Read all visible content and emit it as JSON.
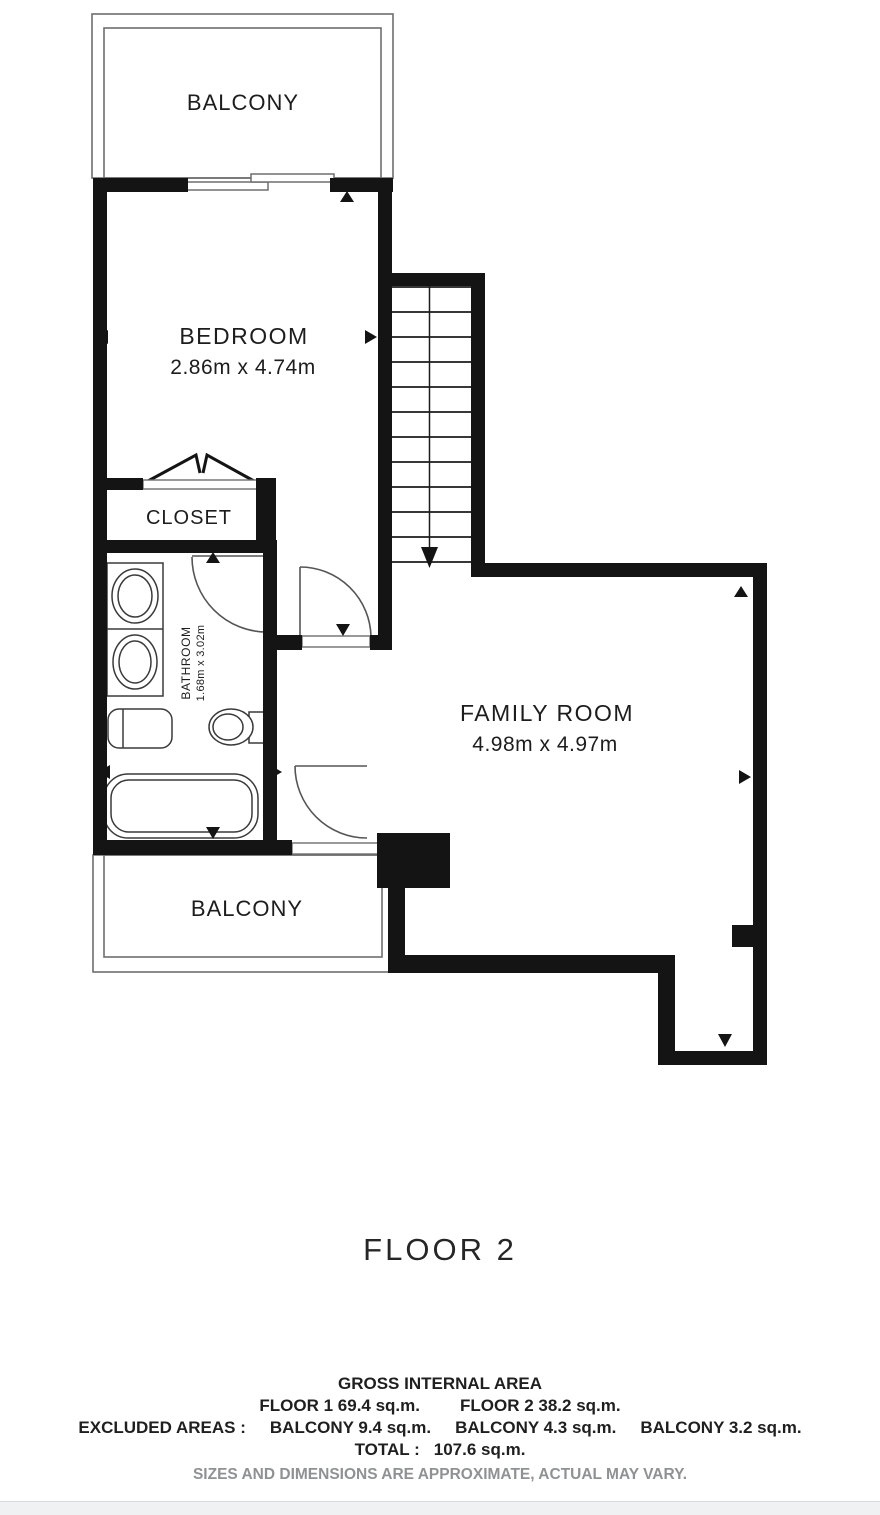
{
  "plan": {
    "rooms": {
      "balcony_top": {
        "label": "BALCONY"
      },
      "bedroom": {
        "label": "BEDROOM",
        "dims": "2.86m x 4.74m"
      },
      "closet": {
        "label": "CLOSET"
      },
      "bathroom": {
        "label": "BATHROOM",
        "dims": "1.68m x 3.02m"
      },
      "family_room": {
        "label": "FAMILY ROOM",
        "dims": "4.98m x 4.97m"
      },
      "balcony_bottom": {
        "label": "BALCONY"
      }
    },
    "colors": {
      "wall": "#141414",
      "thin_line": "#6e6e6e",
      "door_arc": "#555555",
      "fixture": "#3a3a3a",
      "text": "#1d1d1d",
      "note_gray": "#8f9193",
      "footer_bar": "#eff1f2"
    }
  },
  "title": {
    "floor_label": "FLOOR 2"
  },
  "summary": {
    "heading": "GROSS INTERNAL AREA",
    "floor1": "FLOOR 1 69.4 sq.m.",
    "floor2": "FLOOR 2 38.2 sq.m.",
    "excluded_label": "EXCLUDED AREAS :",
    "balcony1": "BALCONY 9.4 sq.m.",
    "balcony2": "BALCONY 4.3 sq.m.",
    "balcony3": "BALCONY 3.2 sq.m.",
    "total_label": "TOTAL :",
    "total_value": "107.6 sq.m.",
    "disclaimer": "SIZES AND DIMENSIONS ARE APPROXIMATE, ACTUAL MAY VARY."
  }
}
